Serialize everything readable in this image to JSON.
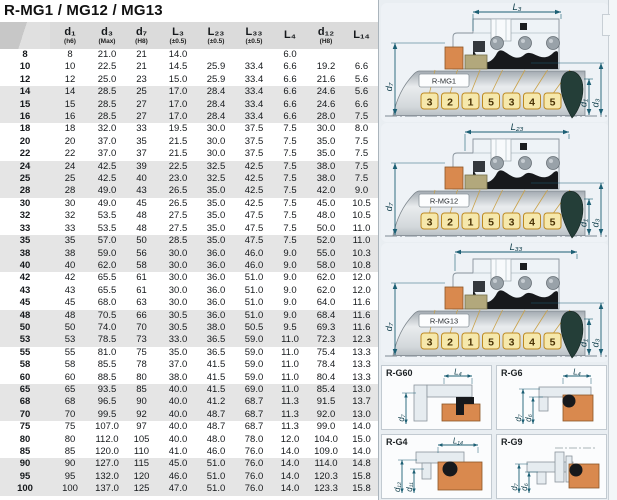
{
  "title": "R-MG1 / MG12 / MG13",
  "table": {
    "columns": [
      {
        "label": "",
        "note": ""
      },
      {
        "label": "d₁",
        "note": "(h6)"
      },
      {
        "label": "d₃",
        "note": "(Max)"
      },
      {
        "label": "d₇",
        "note": "(H8)"
      },
      {
        "label": "L₃",
        "note": "(±0.5)"
      },
      {
        "label": "L₂₃",
        "note": "(±0.5)"
      },
      {
        "label": "L₃₃",
        "note": "(±0.5)"
      },
      {
        "label": "L₄",
        "note": ""
      },
      {
        "label": "d₁₂",
        "note": "(H8)"
      },
      {
        "label": "L₁₄",
        "note": ""
      }
    ],
    "rows": [
      [
        "8",
        "8",
        "21.0",
        "21",
        "14.0",
        "",
        "",
        "6.0",
        "",
        ""
      ],
      [
        "10",
        "10",
        "22.5",
        "21",
        "14.5",
        "25.9",
        "33.4",
        "6.6",
        "19.2",
        "6.6"
      ],
      [
        "12",
        "12",
        "25.0",
        "23",
        "15.0",
        "25.9",
        "33.4",
        "6.6",
        "21.6",
        "5.6"
      ],
      [
        "14",
        "14",
        "28.5",
        "25",
        "17.0",
        "28.4",
        "33.4",
        "6.6",
        "24.6",
        "5.6"
      ],
      [
        "15",
        "15",
        "28.5",
        "27",
        "17.0",
        "28.4",
        "33.4",
        "6.6",
        "24.6",
        "6.6"
      ],
      [
        "16",
        "16",
        "28.5",
        "27",
        "17.0",
        "28.4",
        "33.4",
        "6.6",
        "28.0",
        "7.5"
      ],
      [
        "18",
        "18",
        "32.0",
        "33",
        "19.5",
        "30.0",
        "37.5",
        "7.5",
        "30.0",
        "8.0"
      ],
      [
        "20",
        "20",
        "37.0",
        "35",
        "21.5",
        "30.0",
        "37.5",
        "7.5",
        "35.0",
        "7.5"
      ],
      [
        "22",
        "22",
        "37.0",
        "37",
        "21.5",
        "30.0",
        "37.5",
        "7.5",
        "35.0",
        "7.5"
      ],
      [
        "24",
        "24",
        "42.5",
        "39",
        "22.5",
        "32.5",
        "42.5",
        "7.5",
        "38.0",
        "7.5"
      ],
      [
        "25",
        "25",
        "42.5",
        "40",
        "23.0",
        "32.5",
        "42.5",
        "7.5",
        "38.0",
        "7.5"
      ],
      [
        "28",
        "28",
        "49.0",
        "43",
        "26.5",
        "35.0",
        "42.5",
        "7.5",
        "42.0",
        "9.0"
      ],
      [
        "30",
        "30",
        "49.0",
        "45",
        "26.5",
        "35.0",
        "42.5",
        "7.5",
        "45.0",
        "10.5"
      ],
      [
        "32",
        "32",
        "53.5",
        "48",
        "27.5",
        "35.0",
        "47.5",
        "7.5",
        "48.0",
        "10.5"
      ],
      [
        "33",
        "33",
        "53.5",
        "48",
        "27.5",
        "35.0",
        "47.5",
        "7.5",
        "50.0",
        "11.0"
      ],
      [
        "35",
        "35",
        "57.0",
        "50",
        "28.5",
        "35.0",
        "47.5",
        "7.5",
        "52.0",
        "11.0"
      ],
      [
        "38",
        "38",
        "59.0",
        "56",
        "30.0",
        "36.0",
        "46.0",
        "9.0",
        "55.0",
        "10.3"
      ],
      [
        "40",
        "40",
        "62.0",
        "58",
        "30.0",
        "36.0",
        "46.0",
        "9.0",
        "58.0",
        "10.8"
      ],
      [
        "42",
        "42",
        "65.5",
        "61",
        "30.0",
        "36.0",
        "51.0",
        "9.0",
        "62.0",
        "12.0"
      ],
      [
        "43",
        "43",
        "65.5",
        "61",
        "30.0",
        "36.0",
        "51.0",
        "9.0",
        "62.0",
        "12.0"
      ],
      [
        "45",
        "45",
        "68.0",
        "63",
        "30.0",
        "36.0",
        "51.0",
        "9.0",
        "64.0",
        "11.6"
      ],
      [
        "48",
        "48",
        "70.5",
        "66",
        "30.5",
        "36.0",
        "51.0",
        "9.0",
        "68.4",
        "11.6"
      ],
      [
        "50",
        "50",
        "74.0",
        "70",
        "30.5",
        "38.0",
        "50.5",
        "9.5",
        "69.3",
        "11.6"
      ],
      [
        "53",
        "53",
        "78.5",
        "73",
        "33.0",
        "36.5",
        "59.0",
        "11.0",
        "72.3",
        "12.3"
      ],
      [
        "55",
        "55",
        "81.0",
        "75",
        "35.0",
        "36.5",
        "59.0",
        "11.0",
        "75.4",
        "13.3"
      ],
      [
        "58",
        "58",
        "85.5",
        "78",
        "37.0",
        "41.5",
        "59.0",
        "11.0",
        "78.4",
        "13.3"
      ],
      [
        "60",
        "60",
        "88.5",
        "80",
        "38.0",
        "41.5",
        "59.0",
        "11.0",
        "80.4",
        "13.3"
      ],
      [
        "65",
        "65",
        "93.5",
        "85",
        "40.0",
        "41.5",
        "69.0",
        "11.0",
        "85.4",
        "13.0"
      ],
      [
        "68",
        "68",
        "96.5",
        "90",
        "40.0",
        "41.2",
        "68.7",
        "11.3",
        "91.5",
        "13.7"
      ],
      [
        "70",
        "70",
        "99.5",
        "92",
        "40.0",
        "48.7",
        "68.7",
        "11.3",
        "92.0",
        "13.0"
      ],
      [
        "75",
        "75",
        "107.0",
        "97",
        "40.0",
        "48.7",
        "68.7",
        "11.3",
        "99.0",
        "14.0"
      ],
      [
        "80",
        "80",
        "112.0",
        "105",
        "40.0",
        "48.0",
        "78.0",
        "12.0",
        "104.0",
        "15.0"
      ],
      [
        "85",
        "85",
        "120.0",
        "110",
        "41.0",
        "46.0",
        "76.0",
        "14.0",
        "109.0",
        "14.0"
      ],
      [
        "90",
        "90",
        "127.0",
        "115",
        "45.0",
        "51.0",
        "76.0",
        "14.0",
        "114.0",
        "14.8"
      ],
      [
        "95",
        "95",
        "132.0",
        "120",
        "46.0",
        "51.0",
        "76.0",
        "14.0",
        "120.3",
        "15.8"
      ],
      [
        "100",
        "100",
        "137.0",
        "125",
        "47.0",
        "51.0",
        "76.0",
        "14.0",
        "123.3",
        "15.8"
      ]
    ]
  },
  "diagrams": {
    "main": [
      {
        "label": "R-MG1",
        "dim_top": "L₃",
        "dim_left": "d₇",
        "dim_right_inner": "d₁",
        "dim_right_outer": "d₃",
        "tags": [
          "3",
          "2",
          "1",
          "5",
          "3",
          "4",
          "5"
        ]
      },
      {
        "label": "R-MG12",
        "dim_top": "L₂₃",
        "dim_left": "d₇",
        "dim_right_inner": "d₁",
        "dim_right_outer": "d₃",
        "tags": [
          "3",
          "2",
          "1",
          "5",
          "3",
          "4",
          "5"
        ]
      },
      {
        "label": "R-MG13",
        "dim_top": "L₃₃",
        "dim_left": "d₇",
        "dim_right_inner": "d₁",
        "dim_right_outer": "d₃",
        "tags": [
          "3",
          "2",
          "1",
          "5",
          "3",
          "4",
          "5"
        ]
      }
    ],
    "small": [
      {
        "label": "R-G60",
        "dim_top": "L₄",
        "dims_left": [
          "d₇"
        ]
      },
      {
        "label": "R-G6",
        "dim_top": "L₄",
        "dims_left": [
          "d₇",
          "d₆"
        ]
      },
      {
        "label": "R-G4",
        "dim_top": "L₁₄",
        "dims_left": [
          "d₁₂",
          "d₁₁"
        ]
      },
      {
        "label": "R-G9",
        "dim_top": "",
        "dims_left": [
          "d₇",
          "d₆"
        ]
      }
    ]
  },
  "colors": {
    "dimension_accent": "#1c5f74",
    "seal_orange": "#d9894e",
    "tag_yellow": "#f6e8ab",
    "drop_dark_teal": "#243e38",
    "stripe_gray": "#e5e5e5"
  }
}
